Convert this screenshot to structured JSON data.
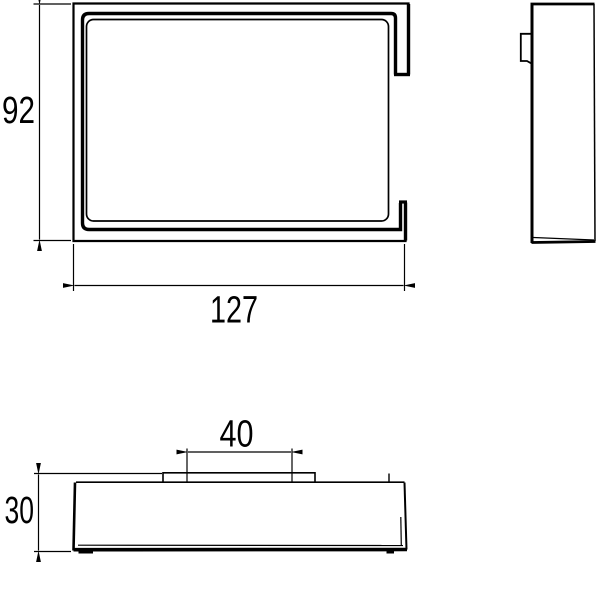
{
  "drawing": {
    "background_color": "#ffffff",
    "line_color": "#000000",
    "views": {
      "front": {
        "height_label": "92",
        "width_label": "127"
      },
      "side": {},
      "bottom": {
        "plate_width_label": "40",
        "depth_label": "30"
      }
    }
  }
}
